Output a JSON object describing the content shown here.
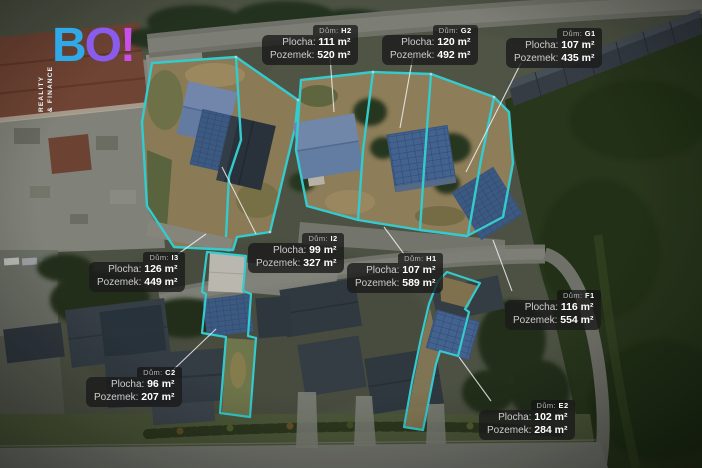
{
  "logo": {
    "letter_b": "B",
    "letter_o": "O",
    "letter_bang": "!",
    "tagline_line1": "REALITY",
    "tagline_line2": "& FINANCE"
  },
  "keys": {
    "house": "Dům:",
    "area": "Plocha:",
    "plot": "Pozemek:"
  },
  "plots": [
    {
      "house": "H2",
      "area": "111 m²",
      "plot": "520 m²",
      "box": {
        "x": 262,
        "y": 25
      },
      "leader": [
        330,
        56,
        334,
        112
      ]
    },
    {
      "house": "G2",
      "area": "120 m²",
      "plot": "492 m²",
      "box": {
        "x": 382,
        "y": 25
      },
      "leader": [
        413,
        56,
        400,
        128
      ]
    },
    {
      "house": "G1",
      "area": "107 m²",
      "plot": "435 m²",
      "box": {
        "x": 506,
        "y": 28
      },
      "leader": [
        521,
        63,
        466,
        172
      ]
    },
    {
      "house": "I2",
      "area": "99 m²",
      "plot": "327 m²",
      "box": {
        "x": 248,
        "y": 233
      },
      "leader": [
        256,
        234,
        222,
        167
      ]
    },
    {
      "house": "I3",
      "area": "126 m²",
      "plot": "449 m²",
      "box": {
        "x": 89,
        "y": 252
      },
      "leader": [
        178,
        254,
        206,
        234
      ]
    },
    {
      "house": "H1",
      "area": "107 m²",
      "plot": "589 m²",
      "box": {
        "x": 347,
        "y": 253
      },
      "leader": [
        404,
        254,
        384,
        227
      ]
    },
    {
      "house": "F1",
      "area": "116 m²",
      "plot": "554 m²",
      "box": {
        "x": 505,
        "y": 290
      },
      "leader": [
        512,
        291,
        493,
        240
      ]
    },
    {
      "house": "C2",
      "area": "96 m²",
      "plot": "207 m²",
      "box": {
        "x": 86,
        "y": 367
      },
      "leader": [
        172,
        371,
        216,
        329
      ]
    },
    {
      "house": "E2",
      "area": "102 m²",
      "plot": "284 m²",
      "box": {
        "x": 479,
        "y": 400
      },
      "leader": [
        491,
        401,
        459,
        357
      ]
    }
  ],
  "accent_colors": {
    "plot_outline": "#39e0e6",
    "label_bg": "rgba(26,26,26,0.8)",
    "logo_blue": "#2fa9e8",
    "logo_purple": "#8a5ced",
    "logo_magenta": "#c94fe8"
  }
}
